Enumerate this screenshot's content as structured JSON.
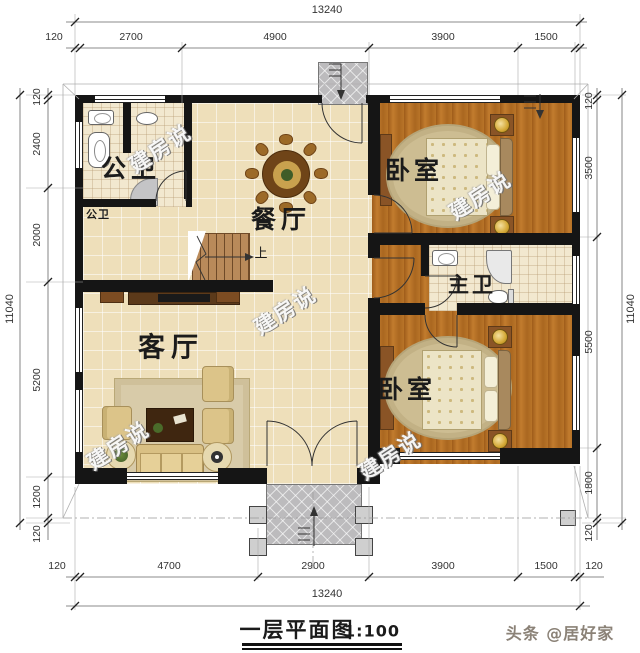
{
  "meta": {
    "title_text": "一层平面图",
    "title_scale": "1:100",
    "credit": "头条 @居好家",
    "watermark": "建房说"
  },
  "rooms": {
    "public_bath": "公卫",
    "public_bath_sub": "公卫",
    "dining": "餐厅",
    "living": "客厅",
    "bedroom_top": "卧室",
    "bedroom_bottom": "卧室",
    "master_bath": "主卫",
    "stair_up": "上"
  },
  "dimensions": {
    "top": {
      "total": "13240",
      "segments": [
        "120",
        "2700",
        "4900",
        "3900",
        "1500"
      ]
    },
    "bottom": {
      "total": "13240",
      "segments": [
        "120",
        "4700",
        "2900",
        "3900",
        "1500",
        "120"
      ]
    },
    "left": {
      "total": "11040",
      "segments": [
        "120",
        "2400",
        "2000",
        "5200",
        "1200",
        "120"
      ]
    },
    "right": {
      "total": "11040",
      "segments": [
        "120",
        "3500",
        "5500",
        "1800",
        "120"
      ]
    }
  },
  "colors": {
    "wall": "#151515",
    "tile_floor": "#eedfba",
    "bath_floor": "#f2e8cf",
    "wood_floor": "#b06a24",
    "porch": "#bcbbbd",
    "dim_text": "#333333"
  }
}
